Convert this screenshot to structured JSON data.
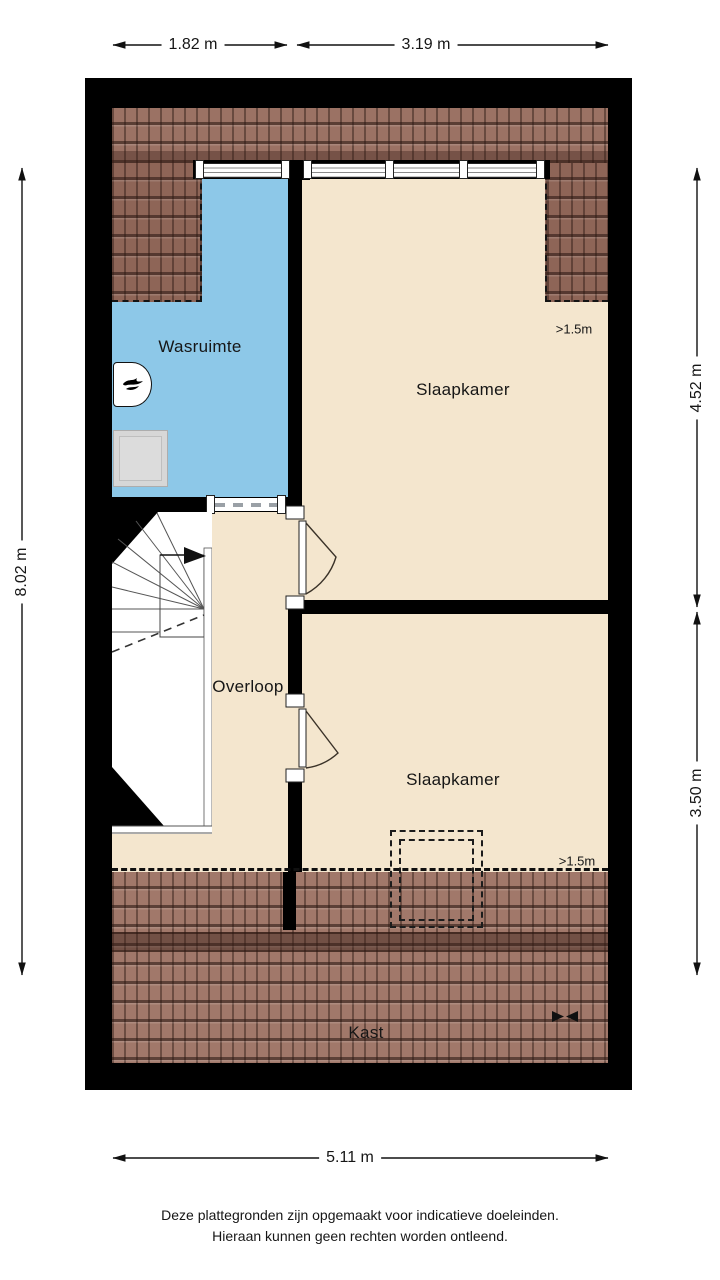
{
  "dimensions": {
    "top_left": "1.82 m",
    "top_right": "3.19 m",
    "left": "8.02 m",
    "right_top": "4.52 m",
    "right_bottom": "3.50 m",
    "bottom": "5.11 m"
  },
  "rooms": {
    "wasruimte": {
      "label": "Wasruimte"
    },
    "slaapkamer_top": {
      "label": "Slaapkamer",
      "headroom": ">1.5m"
    },
    "overloop": {
      "label": "Overloop"
    },
    "slaapkamer_bottom": {
      "label": "Slaapkamer",
      "headroom": ">1.5m"
    },
    "kast": {
      "label": "Kast"
    }
  },
  "icons": {
    "boiler": "flame-icon",
    "washing_machine": "washing-machine-icon",
    "stairs_direction": "arrow-right-icon",
    "kast_symbol": "bowtie-symbol-icon"
  },
  "disclaimer": {
    "line1": "Deze plattegronden zijn opgemaakt voor indicatieve doeleinden.",
    "line2": "Hieraan kunnen geen rechten worden ontleend."
  },
  "colors": {
    "wall": "#000000",
    "floor": "#f4e6ce",
    "wet_room": "#8dc8e8",
    "roof": "#9b7264",
    "roof_corner": "#8e6557",
    "roof_bottom": "#a1786a",
    "roof_ridge": "#6f493d",
    "text": "#161616"
  }
}
